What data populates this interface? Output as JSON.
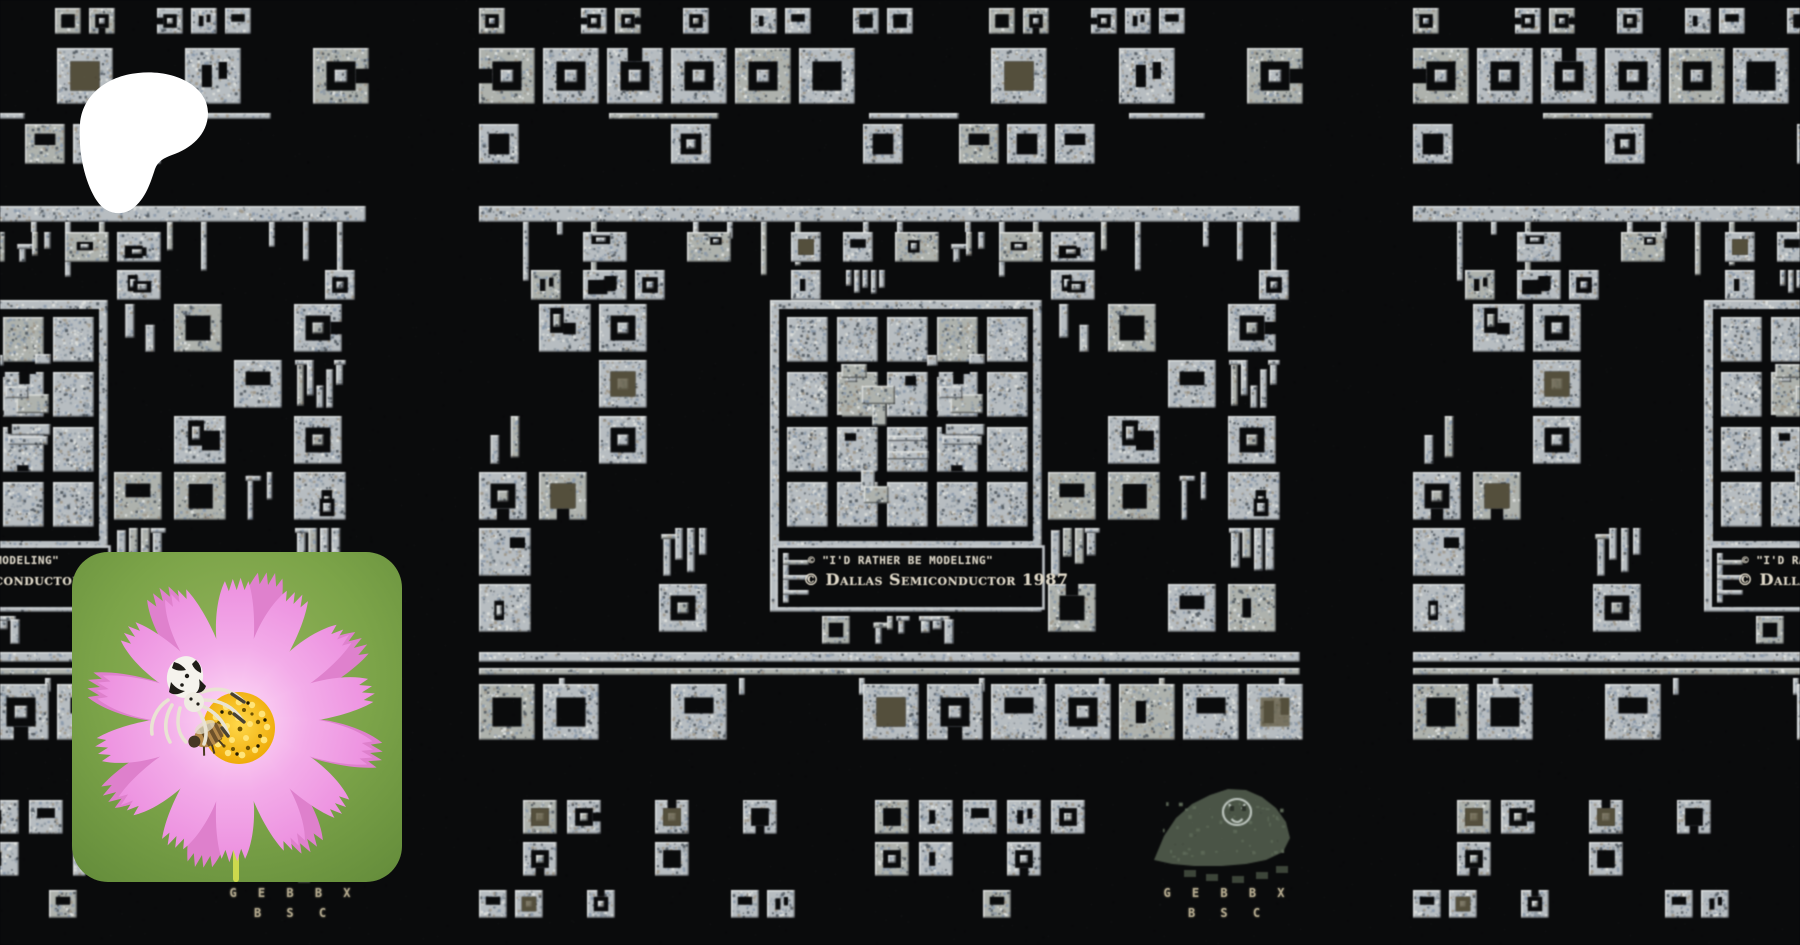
{
  "page": {
    "description": "Patreon creator page cover: tiled photograph of a Dallas Semiconductor chip die, white Patreon logo top-left, flower avatar bottom-left"
  },
  "brand": {
    "logo_name": "patreon-logo",
    "logo_color": "#ffffff"
  },
  "banner": {
    "subject": "Microchip die photograph, repeated in three tiles",
    "die_text": {
      "slogan": "© \"I'd rather be modeling\"",
      "copyright": "© Dallas Semiconductor 1987",
      "initials_row1": "G E B B X",
      "initials_row2": "B S C"
    },
    "colors": {
      "background": "#0a0b0d",
      "metal_light": "#bcc3c8",
      "metal_alt": "#b3b8b2",
      "highlight": "#eef1ef",
      "shadow": "#0f1214",
      "speckles": [
        "#95a1ab",
        "#e3e6e3",
        "#59626a",
        "#a79f90",
        "#8fa0b4"
      ],
      "olive_cell": "#6a6347",
      "gorilla_body": "#4b5747",
      "gorilla_noise": "#5d6b57",
      "gorilla_face_line": "#c6d0c8",
      "gorilla_feet": "#3d4739",
      "band_border": "#c9ced2",
      "band_text": "#d6d0c2",
      "initials_text": "#b3a98e"
    }
  },
  "avatar": {
    "alt": "Crab spider and honeybee on a pink cosmos flower",
    "colors": {
      "background_green": "#7ca449",
      "petal_pink": "#ee93e0",
      "petal_light": "#fbd4f4",
      "petal_back": "#e47fd4",
      "disc_yellow": "#f3ae06",
      "stamen_yellow": "#ffe478",
      "spider_white": "#f5f3ed",
      "spider_marks": "#1f1d18",
      "bee_brown": "#b5894a",
      "stem_green": "#ccd94d"
    }
  }
}
